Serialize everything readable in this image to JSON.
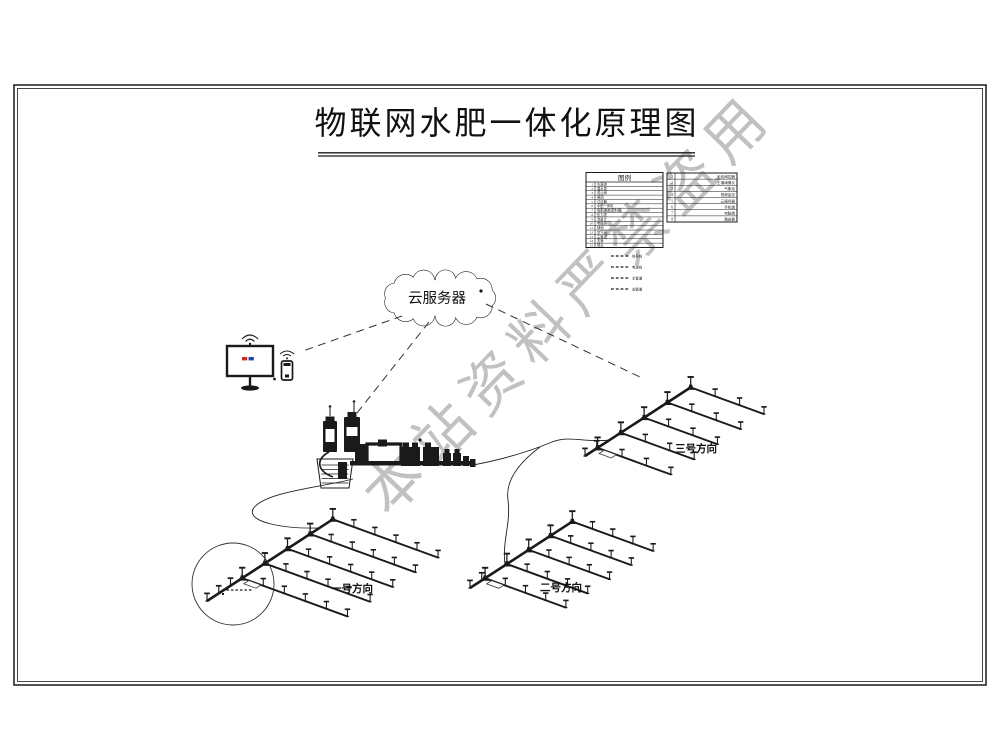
{
  "title": "物联网水肥一体化原理图",
  "watermark": "本站资料严禁盗用",
  "cloud": {
    "label": "云服务器"
  },
  "legend_left": {
    "header": "图例",
    "rows": [
      [
        "1",
        "水源池"
      ],
      [
        "2",
        "潜水泵"
      ],
      [
        "3",
        "逆止阀"
      ],
      [
        "4",
        "闸阀"
      ],
      [
        "5",
        "过滤器"
      ],
      [
        "6",
        "水肥一体机"
      ],
      [
        "7",
        "吸肥通道(肥料桶)"
      ],
      [
        "8",
        "压力表"
      ],
      [
        "9",
        "流量计"
      ],
      [
        "10",
        "电磁阀"
      ],
      [
        "11",
        "球阀"
      ],
      [
        "12",
        "空气阀"
      ],
      [
        "13",
        "主管道"
      ],
      [
        "14",
        "支管"
      ],
      [
        "15",
        "喷头"
      ]
    ]
  },
  "legend_right": {
    "rows": [
      [
        "1",
        "无线阀控器"
      ],
      [
        "2",
        "土壤墒情仪"
      ],
      [
        "3",
        "气象站"
      ],
      [
        "4",
        "视频监控"
      ],
      [
        "5",
        "云服务器"
      ],
      [
        "6",
        "手机端"
      ],
      [
        "7",
        "电脑端"
      ],
      [
        "8",
        "路由器"
      ]
    ]
  },
  "line_legend": [
    {
      "label": "信号线"
    },
    {
      "label": "电源线"
    },
    {
      "label": "主管道"
    },
    {
      "label": "支管道"
    }
  ],
  "fields": [
    {
      "label": "一号方向"
    },
    {
      "label": "二号方向"
    },
    {
      "label": "三号方向"
    }
  ],
  "colors": {
    "ink": "#1a1a1a",
    "watermark": "#8f8f8f",
    "screen_red": "#c03028",
    "screen_blue": "#2040b0"
  }
}
